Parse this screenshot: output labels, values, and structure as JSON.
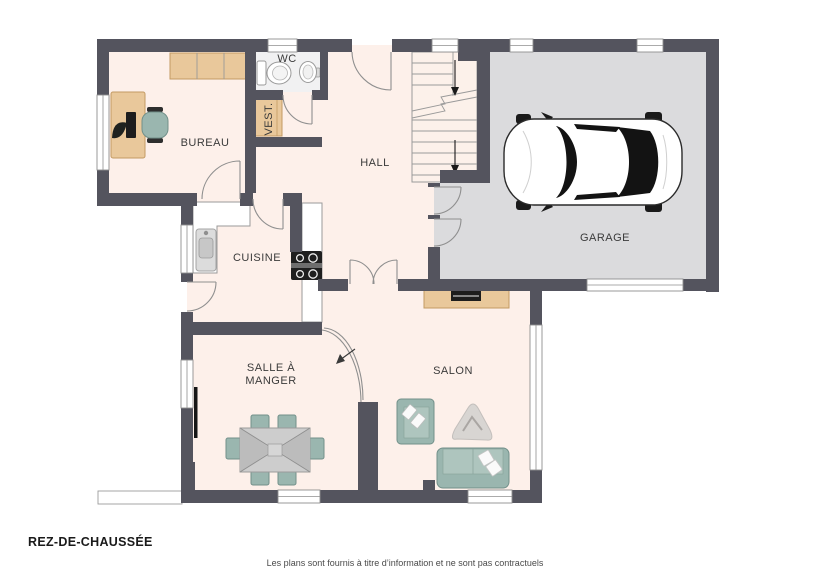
{
  "title": "REZ-DE-CHAUSSÉE",
  "disclaimer": "Les plans sont fournis à titre d’information et ne sont pas contractuels",
  "rooms": {
    "bureau": {
      "label": "BUREAU"
    },
    "wc": {
      "label": "WC"
    },
    "vestiaire": {
      "label": "VEST."
    },
    "hall": {
      "label": "HALL"
    },
    "garage": {
      "label": "GARAGE"
    },
    "cuisine": {
      "label": "CUISINE"
    },
    "salle_a_manger": {
      "label_line1": "SALLE À",
      "label_line2": "MANGER"
    },
    "salon": {
      "label": "SALON"
    }
  },
  "colors": {
    "wall": "#54545e",
    "floor": "#fdf0ea",
    "garage_floor": "#dbdbdd",
    "wc_floor": "#f1f1f2",
    "wood": "#e9c89b",
    "wood_line": "#c39a63",
    "seat": "#9ab6af",
    "seat_line": "#72908a",
    "counter": "#ffffff"
  },
  "furniture": [
    "desk",
    "office-chair",
    "wall-shelf",
    "toilet",
    "washbasin",
    "wardrobe",
    "staircase",
    "car",
    "kitchen-counter",
    "kitchen-sink",
    "cooktop",
    "dining-table",
    "dining-chairs",
    "sideboard",
    "tv",
    "armchair",
    "rug",
    "sofa",
    "radiator",
    "entrance-step"
  ]
}
